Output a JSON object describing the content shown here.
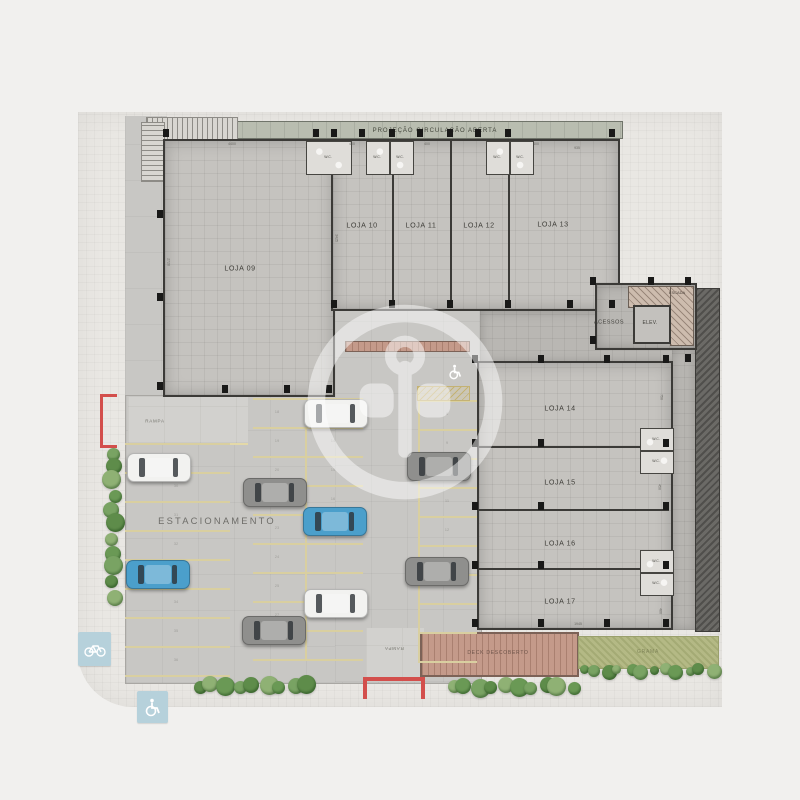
{
  "labels": {
    "banner": "PROJEÇÃO CIRCULAÇÃO ABERTA",
    "parking": "ESTACIONAMENTO",
    "ramp_top": "RAMPA",
    "ramp_bottom": "RAMPA",
    "deck": "DECK DESCOBERTO",
    "grass": "GRAMA",
    "acessos": "ACESSOS",
    "elev": "ELEV.",
    "escada": "ESCADA",
    "wc": "W.C."
  },
  "stores": [
    {
      "label": "LOJA 09",
      "x": 240,
      "y": 268
    },
    {
      "label": "LOJA 10",
      "x": 362,
      "y": 225
    },
    {
      "label": "LOJA 11",
      "x": 421,
      "y": 225
    },
    {
      "label": "LOJA 12",
      "x": 479,
      "y": 225
    },
    {
      "label": "LOJA 13",
      "x": 553,
      "y": 224
    },
    {
      "label": "LOJA 14",
      "x": 560,
      "y": 408
    },
    {
      "label": "LOJA 15",
      "x": 560,
      "y": 482
    },
    {
      "label": "LOJA 16",
      "x": 560,
      "y": 543
    },
    {
      "label": "LOJA 17",
      "x": 560,
      "y": 601
    }
  ],
  "wc_rooms": [
    {
      "x": 306,
      "y": 141,
      "w": 44,
      "h": 32,
      "split": "none",
      "labels": [
        [
          328,
          157
        ]
      ]
    },
    {
      "x": 366,
      "y": 141,
      "w": 46,
      "h": 32,
      "split": "v",
      "labels": [
        [
          377,
          157
        ],
        [
          400,
          157
        ]
      ]
    },
    {
      "x": 486,
      "y": 141,
      "w": 46,
      "h": 32,
      "split": "v",
      "labels": [
        [
          497,
          157
        ],
        [
          520,
          157
        ]
      ]
    },
    {
      "x": 640,
      "y": 428,
      "w": 32,
      "h": 44,
      "split": "h",
      "labels": [
        [
          656,
          439
        ],
        [
          656,
          461
        ]
      ]
    },
    {
      "x": 640,
      "y": 550,
      "w": 32,
      "h": 44,
      "split": "h",
      "labels": [
        [
          656,
          561
        ],
        [
          656,
          583
        ]
      ]
    }
  ],
  "dimensions": [
    {
      "t": "4400",
      "x": 232,
      "y": 144,
      "r": 0
    },
    {
      "t": "400",
      "x": 352,
      "y": 144,
      "r": 0
    },
    {
      "t": "400",
      "x": 427,
      "y": 144,
      "r": 0
    },
    {
      "t": "400",
      "x": 536,
      "y": 144,
      "r": 0
    },
    {
      "t": "935",
      "x": 577,
      "y": 148,
      "r": 0
    },
    {
      "t": "2720",
      "x": 168,
      "y": 262,
      "r": 90
    },
    {
      "t": "3425",
      "x": 336,
      "y": 238,
      "r": 90
    },
    {
      "t": "750",
      "x": 661,
      "y": 397,
      "r": 90
    },
    {
      "t": "450",
      "x": 659,
      "y": 487,
      "r": 90
    },
    {
      "t": "480",
      "x": 660,
      "y": 611,
      "r": 90
    },
    {
      "t": "1945",
      "x": 578,
      "y": 624,
      "r": 0
    }
  ],
  "columns": [
    [
      166,
      133
    ],
    [
      316,
      133
    ],
    [
      334,
      133
    ],
    [
      362,
      133
    ],
    [
      392,
      133
    ],
    [
      420,
      133
    ],
    [
      450,
      133
    ],
    [
      478,
      133
    ],
    [
      508,
      133
    ],
    [
      612,
      133
    ],
    [
      160,
      214
    ],
    [
      160,
      297
    ],
    [
      160,
      386
    ],
    [
      225,
      389
    ],
    [
      287,
      389
    ],
    [
      329,
      389
    ],
    [
      334,
      304
    ],
    [
      392,
      304
    ],
    [
      450,
      304
    ],
    [
      508,
      304
    ],
    [
      570,
      304
    ],
    [
      612,
      304
    ],
    [
      475,
      359
    ],
    [
      541,
      359
    ],
    [
      607,
      359
    ],
    [
      666,
      359
    ],
    [
      475,
      443
    ],
    [
      475,
      506
    ],
    [
      475,
      565
    ],
    [
      475,
      623
    ],
    [
      666,
      443
    ],
    [
      666,
      506
    ],
    [
      666,
      565
    ],
    [
      666,
      623
    ],
    [
      541,
      443
    ],
    [
      541,
      506
    ],
    [
      541,
      565
    ],
    [
      541,
      623
    ],
    [
      607,
      623
    ],
    [
      593,
      281
    ],
    [
      651,
      281
    ],
    [
      688,
      281
    ],
    [
      593,
      340
    ],
    [
      688,
      358
    ]
  ],
  "parking": {
    "line_groups": [
      {
        "x": 125,
        "w": 105,
        "ys": [
          443,
          472,
          501,
          530,
          559,
          588,
          617,
          646,
          675
        ]
      },
      {
        "x": 253,
        "w": 110,
        "ys": [
          398,
          427,
          456,
          485,
          514,
          543,
          572,
          601,
          630,
          659
        ]
      },
      {
        "x": 418,
        "w": 59,
        "ys": [
          400,
          429,
          458,
          487,
          516,
          545,
          574,
          603,
          632,
          661
        ]
      }
    ],
    "vlines": [
      {
        "x": 305,
        "y": 427,
        "h": 232
      },
      {
        "x": 418,
        "y": 386,
        "h": 275
      }
    ],
    "accessible_spot": {
      "x": 417,
      "y": 386,
      "w": 51,
      "h": 13
    },
    "spot_numbers": [
      {
        "n": "29",
        "x": 176,
        "y": 457
      },
      {
        "n": "30",
        "x": 176,
        "y": 486
      },
      {
        "n": "31",
        "x": 176,
        "y": 515
      },
      {
        "n": "32",
        "x": 176,
        "y": 544
      },
      {
        "n": "33",
        "x": 176,
        "y": 573
      },
      {
        "n": "34",
        "x": 176,
        "y": 602
      },
      {
        "n": "35",
        "x": 176,
        "y": 631
      },
      {
        "n": "36",
        "x": 176,
        "y": 660
      },
      {
        "n": "18",
        "x": 277,
        "y": 412
      },
      {
        "n": "19",
        "x": 277,
        "y": 441
      },
      {
        "n": "20",
        "x": 277,
        "y": 470
      },
      {
        "n": "21",
        "x": 277,
        "y": 499
      },
      {
        "n": "23",
        "x": 277,
        "y": 528
      },
      {
        "n": "24",
        "x": 277,
        "y": 557
      },
      {
        "n": "25",
        "x": 277,
        "y": 586
      },
      {
        "n": "27",
        "x": 277,
        "y": 615
      },
      {
        "n": "13",
        "x": 333,
        "y": 412
      },
      {
        "n": "14",
        "x": 333,
        "y": 441
      },
      {
        "n": "15",
        "x": 333,
        "y": 470
      },
      {
        "n": "16",
        "x": 333,
        "y": 499
      },
      {
        "n": "17",
        "x": 333,
        "y": 528
      },
      {
        "n": "8",
        "x": 447,
        "y": 414
      },
      {
        "n": "9",
        "x": 447,
        "y": 443
      },
      {
        "n": "10",
        "x": 447,
        "y": 472
      },
      {
        "n": "11",
        "x": 447,
        "y": 501
      },
      {
        "n": "12",
        "x": 447,
        "y": 530
      }
    ],
    "cars": [
      {
        "x": 127,
        "y": 453,
        "color": "white"
      },
      {
        "x": 126,
        "y": 560,
        "color": "blue"
      },
      {
        "x": 243,
        "y": 478,
        "color": "gray"
      },
      {
        "x": 303,
        "y": 507,
        "color": "blue"
      },
      {
        "x": 304,
        "y": 399,
        "color": "white"
      },
      {
        "x": 304,
        "y": 589,
        "color": "white"
      },
      {
        "x": 242,
        "y": 616,
        "color": "gray"
      },
      {
        "x": 407,
        "y": 452,
        "color": "gray"
      },
      {
        "x": 405,
        "y": 557,
        "color": "gray"
      }
    ]
  },
  "landscape": {
    "bush_rows": [
      {
        "x1": 113,
        "y1": 452,
        "x2": 113,
        "y2": 596,
        "n": 11,
        "r": 8
      },
      {
        "x1": 198,
        "y1": 686,
        "x2": 308,
        "y2": 686,
        "n": 9,
        "r": 8
      },
      {
        "x1": 452,
        "y1": 687,
        "x2": 572,
        "y2": 687,
        "n": 10,
        "r": 8
      },
      {
        "x1": 584,
        "y1": 671,
        "x2": 712,
        "y2": 671,
        "n": 12,
        "r": 6
      }
    ],
    "bush_colors": [
      "#79a363",
      "#5e8c4a",
      "#8fb174",
      "#6a9955"
    ]
  },
  "colors": {
    "car_white": "#f2f2f0",
    "car_gray": "#8f8f8d",
    "car_blue": "#4b9fcb",
    "stall_line": "#d9cfa0",
    "red_marker": "#d34f4c",
    "deck_brown": "#c49a8a",
    "grass_green": "#b4b985",
    "icon_square_blue": "#b6d1db"
  }
}
